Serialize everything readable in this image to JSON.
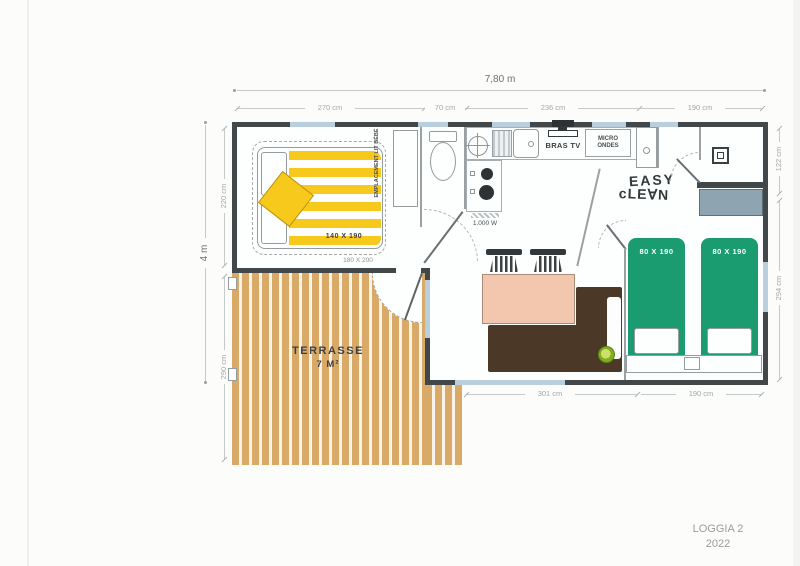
{
  "dims": {
    "top_total": "7,80 m",
    "left_total": "4 m",
    "top": [
      "270 cm",
      "70 cm",
      "236 cm",
      "190 cm"
    ],
    "left": [
      "220 cm",
      "290 cm"
    ],
    "right": [
      "122 cm",
      "294 cm"
    ],
    "bottom": [
      "301 cm",
      "190 cm"
    ]
  },
  "rooms": {
    "terrace": {
      "name": "TERRASSE",
      "area": "7 M²"
    },
    "bedroom_master": {
      "bed_size": "140 X 190",
      "bed_alt_size": "180 X 200",
      "baby_space": "EMPLACEMENT LIT BÉBÉ"
    },
    "bedroom_twin": {
      "bed1_size": "80 X 190",
      "bed2_size": "80 X 190"
    },
    "kitchen": {
      "tv": "BRAS TV",
      "microwave": "MICRO ONDES",
      "hob_power": "1.000 W"
    },
    "branding": {
      "easyclean_line1": "EASY",
      "easyclean_line2": "cLE∀N"
    }
  },
  "footer": {
    "model": "LOGGIA 2",
    "year": "2022"
  },
  "colors": {
    "wall": "#42474a",
    "window": "#b9cfdd",
    "terrace_wood": "#d9a967",
    "duvet_yellow": "#f7c91d",
    "bed_green": "#1b9b70",
    "table_peach": "#f3c7ae",
    "sofa_brown": "#4c3827",
    "cabinet_gray": "#8fa4b1"
  }
}
